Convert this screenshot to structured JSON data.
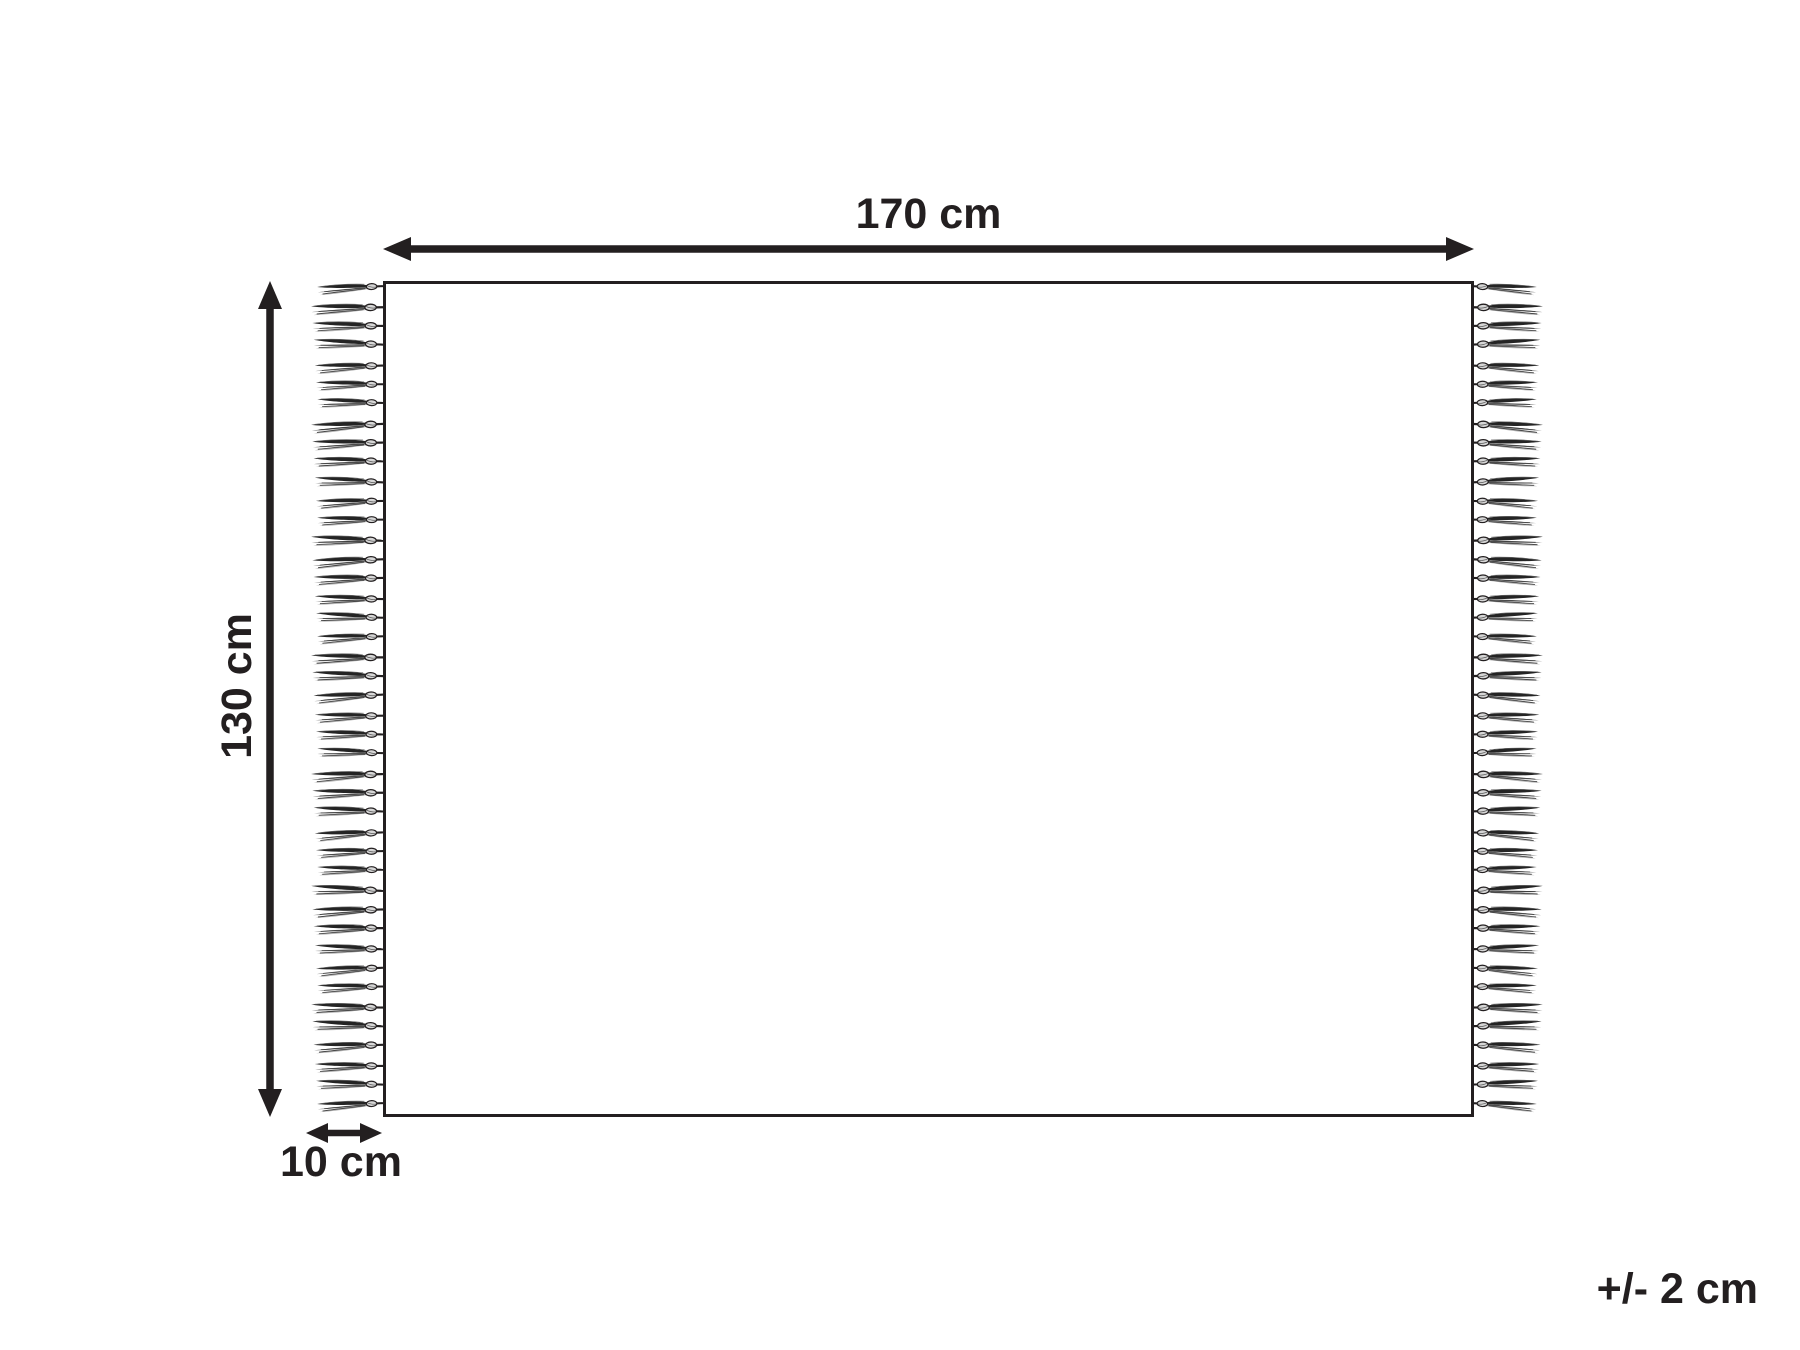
{
  "diagram": {
    "labels": {
      "width": "170 cm",
      "height": "130 cm",
      "fringe": "10 cm",
      "tolerance": "+/- 2 cm"
    },
    "fringe": {
      "tassels_per_side": 43,
      "sides": [
        "left",
        "right"
      ]
    },
    "colors": {
      "ink": "#231f20",
      "background": "#ffffff",
      "tassel_dark": "#242424",
      "tassel_mid": "#8a8a8a",
      "tassel_light": "#b2b2b2",
      "knot_fill": "#d6d6d6"
    }
  }
}
